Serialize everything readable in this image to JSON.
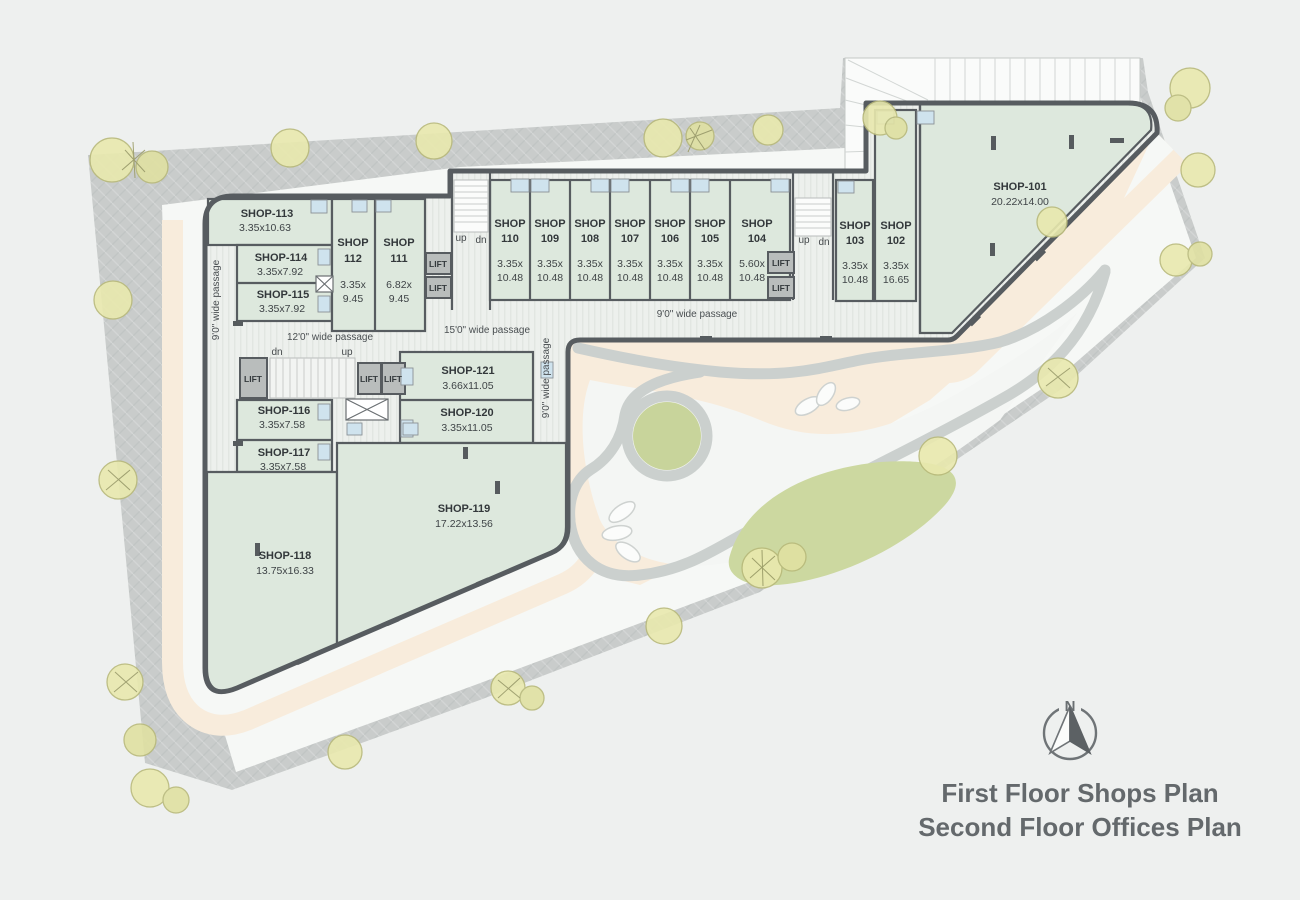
{
  "plan": {
    "title_line1": "First Floor Shops Plan",
    "title_line2": "Second Floor Offices Plan",
    "compass_n": "N",
    "lift": "LIFT",
    "up": "up",
    "dn": "dn",
    "passages": {
      "left_vertical": "9'0\" wide passage",
      "mid_12": "12'0\" wide passage",
      "mid_15": "15'0\" wide passage",
      "top_9": "9'0\" wide passage",
      "center_vertical": "9'0\" wide passage"
    },
    "shops": [
      {
        "id": "101",
        "name": "SHOP-101",
        "size": "20.22x14.00"
      },
      {
        "id": "102",
        "name": "SHOP",
        "num": "102",
        "size1": "3.35x",
        "size2": "16.65"
      },
      {
        "id": "103",
        "name": "SHOP",
        "num": "103",
        "size1": "3.35x",
        "size2": "10.48"
      },
      {
        "id": "104",
        "name": "SHOP",
        "num": "104",
        "size1": "5.60x",
        "size2": "10.48"
      },
      {
        "id": "105",
        "name": "SHOP",
        "num": "105",
        "size1": "3.35x",
        "size2": "10.48"
      },
      {
        "id": "106",
        "name": "SHOP",
        "num": "106",
        "size1": "3.35x",
        "size2": "10.48"
      },
      {
        "id": "107",
        "name": "SHOP",
        "num": "107",
        "size1": "3.35x",
        "size2": "10.48"
      },
      {
        "id": "108",
        "name": "SHOP",
        "num": "108",
        "size1": "3.35x",
        "size2": "10.48"
      },
      {
        "id": "109",
        "name": "SHOP",
        "num": "109",
        "size1": "3.35x",
        "size2": "10.48"
      },
      {
        "id": "110",
        "name": "SHOP",
        "num": "110",
        "size1": "3.35x",
        "size2": "10.48"
      },
      {
        "id": "111",
        "name": "SHOP",
        "num": "111",
        "size1": "6.82x",
        "size2": "9.45"
      },
      {
        "id": "112",
        "name": "SHOP",
        "num": "112",
        "size1": "3.35x",
        "size2": "9.45"
      },
      {
        "id": "113",
        "name": "SHOP-113",
        "size": "3.35x10.63"
      },
      {
        "id": "114",
        "name": "SHOP-114",
        "size": "3.35x7.92"
      },
      {
        "id": "115",
        "name": "SHOP-115",
        "size": "3.35x7.92"
      },
      {
        "id": "116",
        "name": "SHOP-116",
        "size": "3.35x7.58"
      },
      {
        "id": "117",
        "name": "SHOP-117",
        "size": "3.35x7.58"
      },
      {
        "id": "118",
        "name": "SHOP-118",
        "size": "13.75x16.33"
      },
      {
        "id": "119",
        "name": "SHOP-119",
        "size": "17.22x13.56"
      },
      {
        "id": "120",
        "name": "SHOP-120",
        "size": "3.35x11.05"
      },
      {
        "id": "121",
        "name": "SHOP-121",
        "size": "3.66x11.05"
      }
    ],
    "colors": {
      "shop_fill": "#dde8dd",
      "wall": "#575c60",
      "sidewalk": "#c9cccb",
      "walk_peach": "#f8ecdc",
      "lawn_green": "#ccd8a0",
      "circle_green": "#c8d49b",
      "tree": "#e9e9ae",
      "door_blue": "#cfe3ee"
    }
  }
}
